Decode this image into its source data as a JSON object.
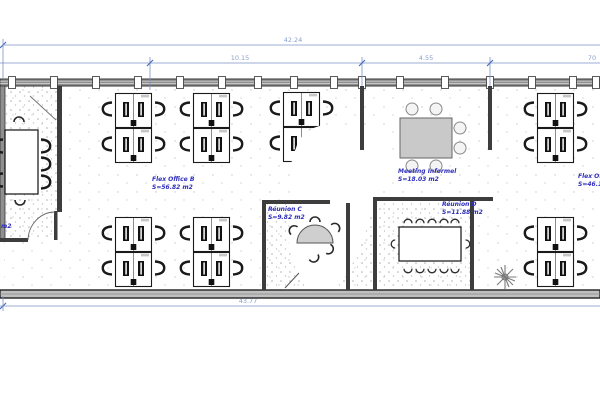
{
  "dimensions": {
    "top_total": "42.24",
    "top_segment_1": "10.15",
    "top_segment_2": "4.55",
    "top_segment_3": "70",
    "bottom_total": "43.77"
  },
  "rooms": {
    "flex_office_b": {
      "name": "Flex Office B",
      "area": "S=56.82 m2"
    },
    "meeting_informel": {
      "name": "Meeting Informel",
      "area": "S=18.03 m2"
    },
    "reunion_c": {
      "name": "Réunion C",
      "area": "S=9.82 m2"
    },
    "reunion_d": {
      "name": "Réunion D",
      "area": "S=11.88 m2"
    },
    "flex_office_right": {
      "name": "Flex Offi",
      "area": "S=46.1"
    },
    "left_room_area_fragment": "m2"
  },
  "colors": {
    "dimension_line": "#7b93c8",
    "dimension_tick": "#4a6db8",
    "dimension_text": "#8ba0cc",
    "room_label_text": "#2f2fbf",
    "wall_dark": "#3d3d3d",
    "wall_band": "#8f8f8f",
    "bottom_band": "#c0c0c0",
    "table_gray": "#c9c9c9",
    "floor_dot": "#b0b0b0"
  }
}
